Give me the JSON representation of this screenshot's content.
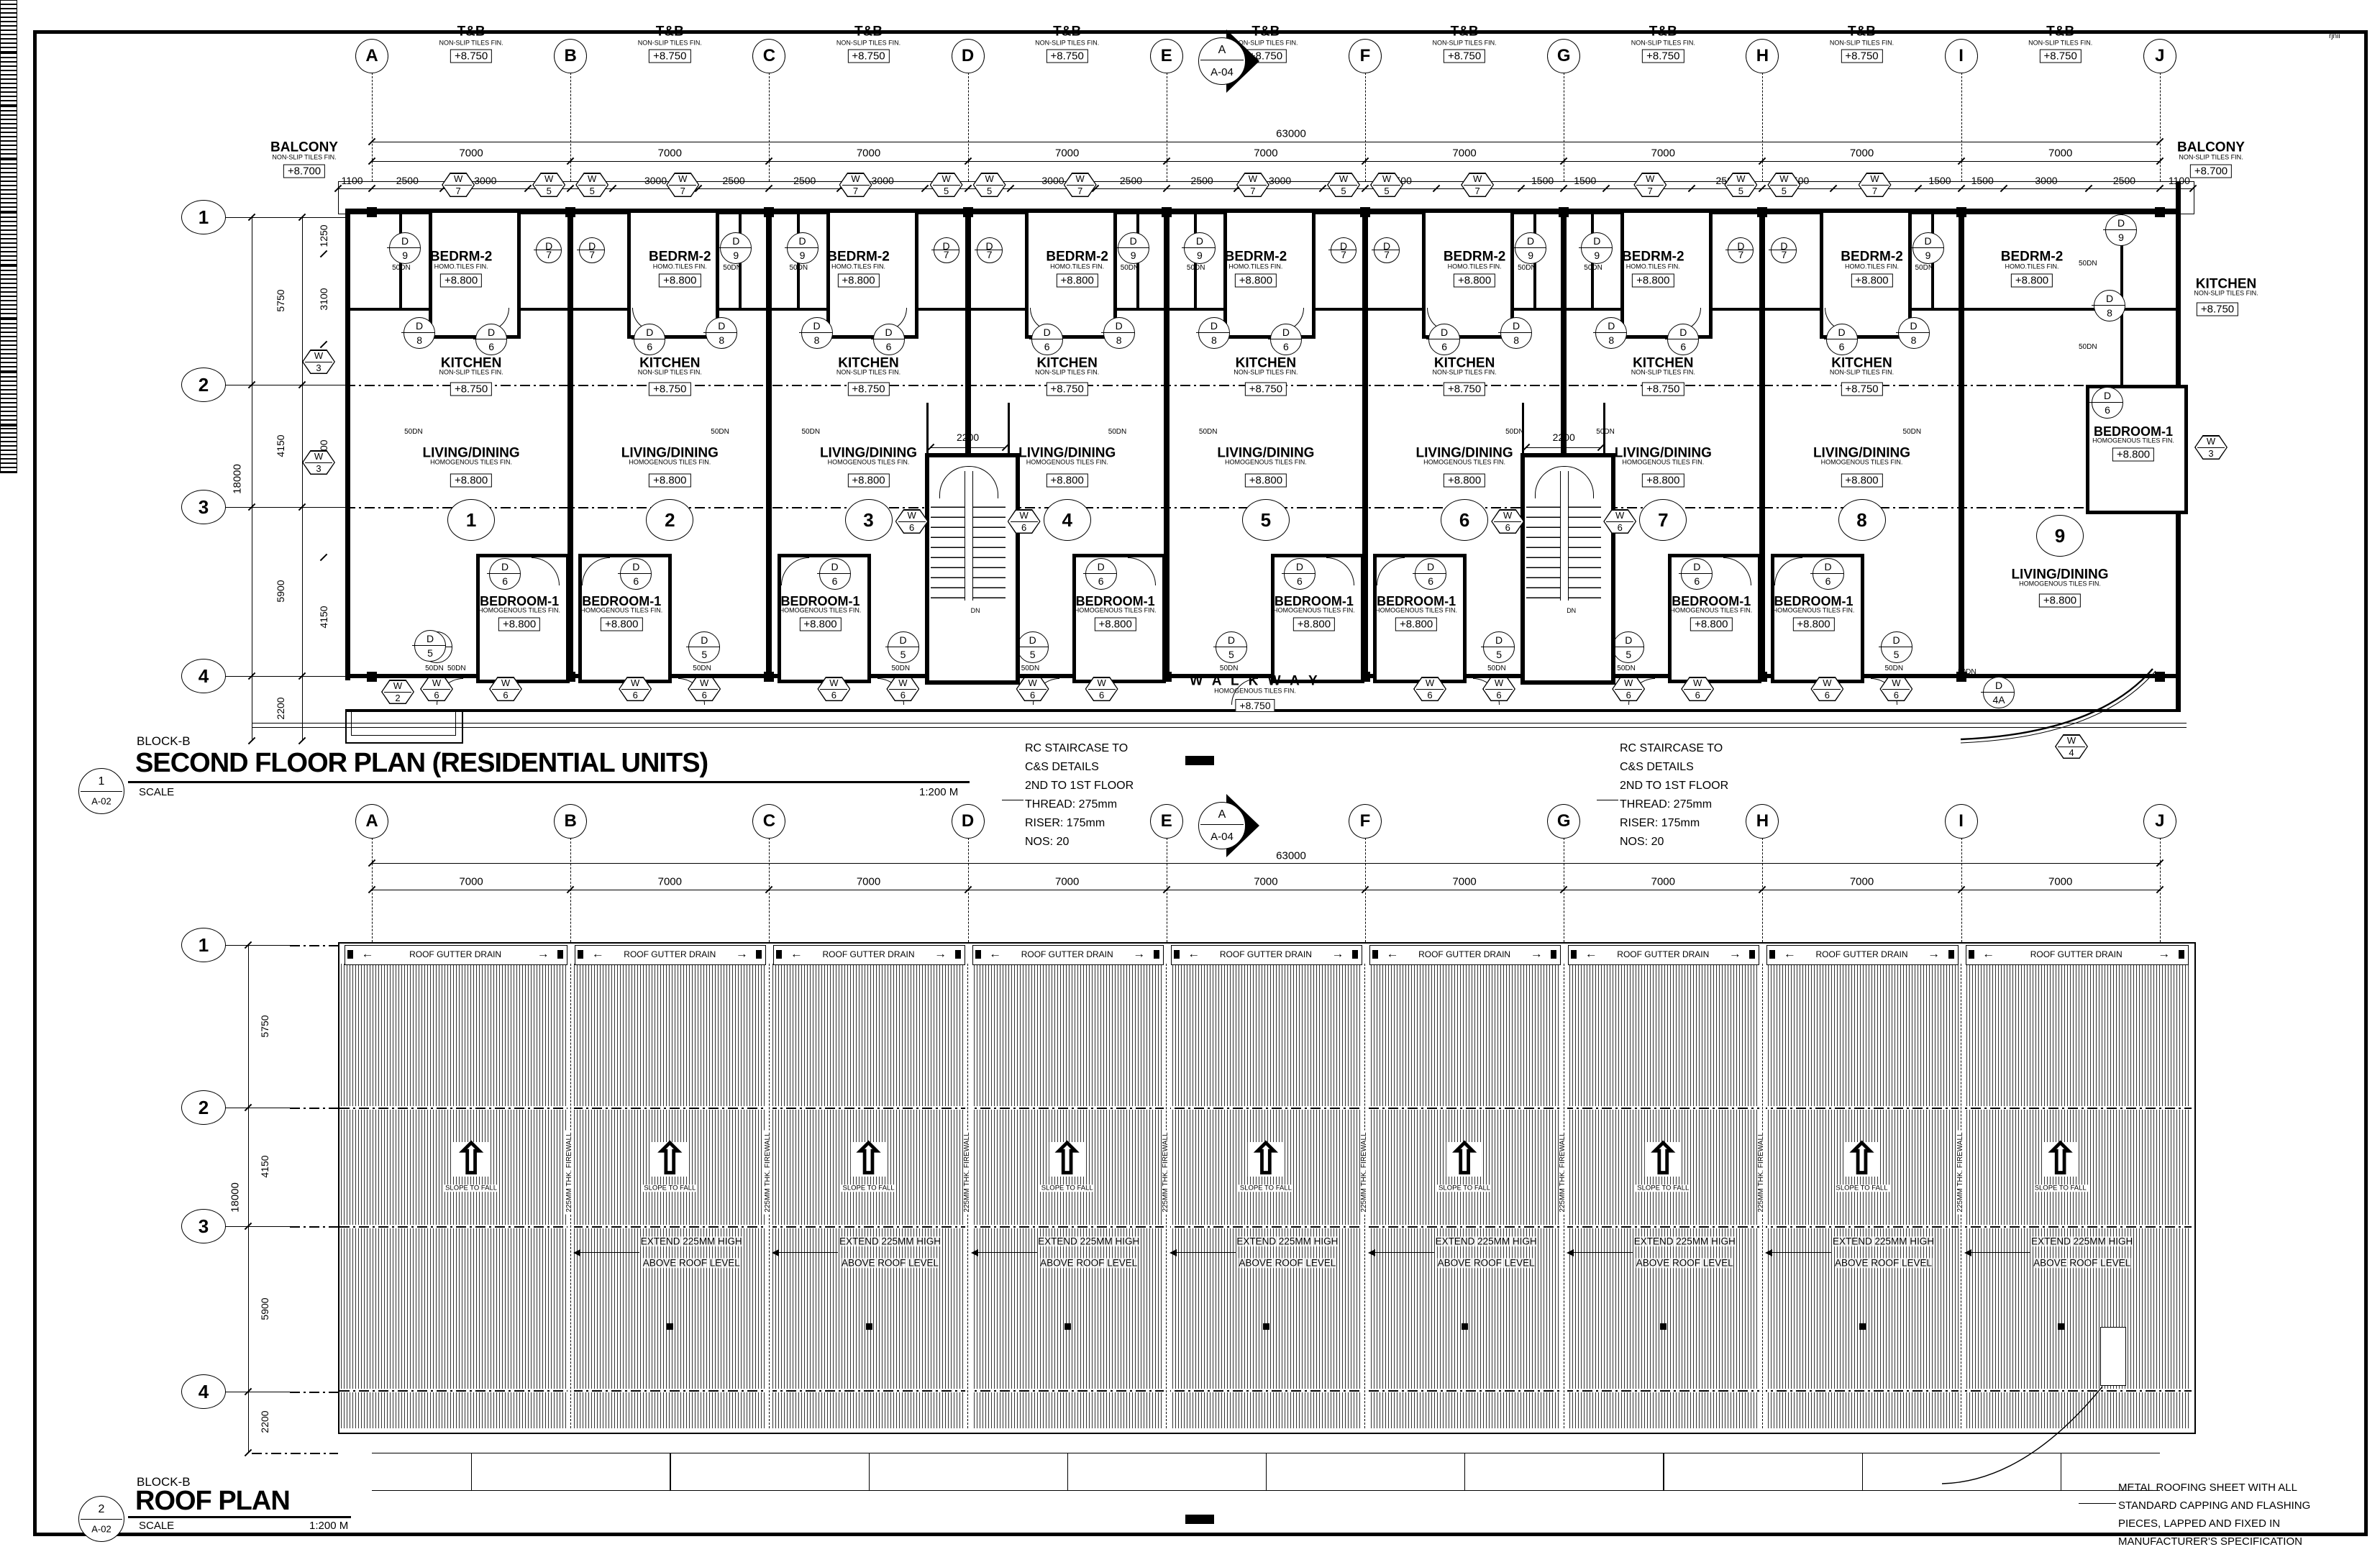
{
  "sheet": {
    "watermark": "rjnii"
  },
  "grid": {
    "columns": [
      "A",
      "B",
      "C",
      "D",
      "E",
      "F",
      "G",
      "H",
      "I",
      "J"
    ],
    "rows": [
      "1",
      "2",
      "3",
      "4"
    ],
    "bay_dim": "7000",
    "total_dim": "63000",
    "end_dim": "1100",
    "sub_dims": [
      [
        "2500",
        "3000",
        "1500"
      ],
      [
        "1500",
        "3000",
        "2500"
      ],
      [
        "2500",
        "3000",
        "1500"
      ],
      [
        "1500",
        "3000",
        "2500"
      ],
      [
        "2500",
        "3000",
        "1500"
      ],
      [
        "2500",
        "3000",
        "1500"
      ],
      [
        "1500",
        "3000",
        "2500"
      ],
      [
        "2500",
        "3000",
        "1500"
      ],
      [
        "1500",
        "3000",
        "2500"
      ]
    ],
    "row_dims": [
      "5750",
      "4150",
      "5900",
      "2200"
    ],
    "row_total": "18000",
    "floor_inner_dims": [
      "1250",
      "3100",
      "7300",
      "4150"
    ]
  },
  "section_marker": {
    "top": "A",
    "bottom": "A-04"
  },
  "titles": {
    "floor": {
      "block": "BLOCK-B",
      "title": "SECOND FLOOR PLAN (RESIDENTIAL UNITS)",
      "scale_label": "SCALE",
      "scale_value": "1:200 M",
      "number": "1",
      "sheet_no": "A-02"
    },
    "roof": {
      "block": "BLOCK-B",
      "title": "ROOF PLAN",
      "scale_label": "SCALE",
      "scale_value": "1:200 M",
      "number": "2",
      "sheet_no": "A-02"
    }
  },
  "floor_plan": {
    "tb": {
      "title": "T&B",
      "finish": "NON-SLIP TILES FIN.",
      "level": "+8.750"
    },
    "balcony": {
      "title": "BALCONY",
      "finish": "NON-SLIP TILES FIN.",
      "level": "+8.700"
    },
    "bedrm2": {
      "title": "BEDRM-2",
      "finish": "HOMO.TILES FIN.",
      "level": "+8.800"
    },
    "kitchen": {
      "title": "KITCHEN",
      "finish": "NON-SLIP TILES FIN.",
      "level": "+8.750"
    },
    "living": {
      "title": "LIVING/DINING",
      "finish": "HOMOGENOUS TILES FIN.",
      "level": "+8.800"
    },
    "bedroom1": {
      "title": "BEDROOM-1",
      "finish": "HOMOGENOUS TILES FIN.",
      "level": "+8.800"
    },
    "walkway": {
      "title": "W A L K W A Y",
      "finish": "HOMOGENOUS TILES FIN.",
      "level": "+8.750"
    },
    "units": [
      "1",
      "2",
      "3",
      "4",
      "5",
      "6",
      "7",
      "8",
      "9"
    ],
    "stair_dim": "2200",
    "down_label": "50DN",
    "dn_label": "DN",
    "tag_letters": {
      "window": "W",
      "door": "D"
    },
    "window_tags": {
      "w2": "2",
      "w3": "3",
      "w4": "4",
      "w5": "5",
      "w6": "6",
      "w7": "7"
    },
    "door_tags": {
      "d4a": "4A",
      "d5": "5",
      "d6": "6",
      "d7": "7",
      "d8": "8",
      "d9": "9"
    },
    "stair_note": [
      "RC STAIRCASE TO",
      "C&S DETAILS",
      "2ND TO 1ST FLOOR",
      "THREAD: 275mm",
      "RISER: 175mm",
      "NOS: 20"
    ]
  },
  "roof_plan": {
    "gutter_label": "ROOF GUTTER DRAIN",
    "slope_label": "SLOPE TO FALL",
    "firewall_label": "225MM THK. FIREWALL",
    "extend_note": [
      "EXTEND 225MM HIGH",
      "ABOVE ROOF LEVEL"
    ],
    "roofing_note": [
      "METAL ROOFING SHEET WITH ALL",
      "STANDARD CAPPING AND FLASHING",
      "PIECES, LAPPED AND FIXED IN",
      "MANUFACTURER'S SPECIFICATION"
    ]
  }
}
